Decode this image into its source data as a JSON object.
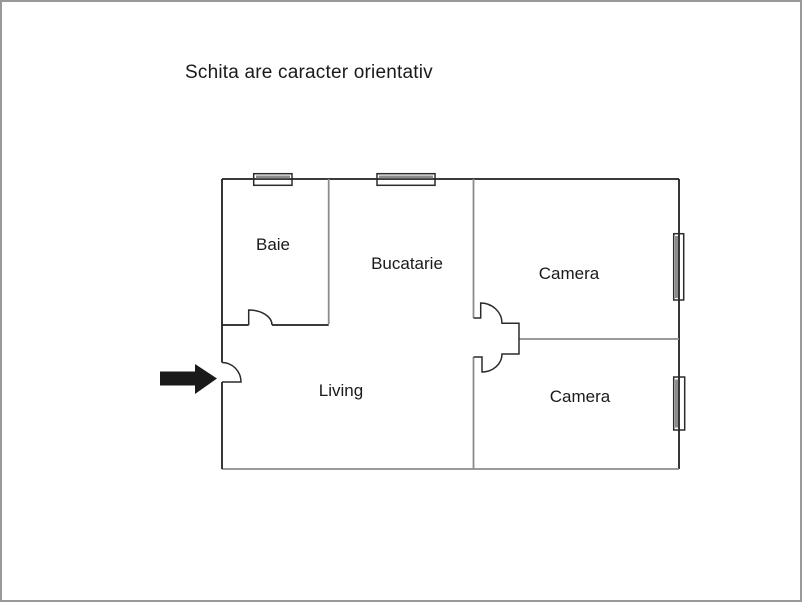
{
  "canvas": {
    "width": 802,
    "height": 602,
    "background": "#ffffff",
    "border_color": "#999999"
  },
  "title": {
    "text": "Schita are caracter orientativ"
  },
  "floorplan": {
    "colors": {
      "outer_wall": "#1f1f1f",
      "inner_wall": "#8c8c8c",
      "door": "#2b2b2b",
      "window_frame": "#2b2b2b",
      "window_glass": "#8c8c8c",
      "arrow": "#1a1a1a",
      "label": "#1a1a1a"
    },
    "rooms": [
      {
        "id": "baie",
        "label": "Baie"
      },
      {
        "id": "bucatarie",
        "label": "Bucatarie"
      },
      {
        "id": "camera-1",
        "label": "Camera"
      },
      {
        "id": "camera-2",
        "label": "Camera"
      },
      {
        "id": "living",
        "label": "Living"
      }
    ],
    "entrance": {
      "icon": "arrow-right"
    }
  }
}
